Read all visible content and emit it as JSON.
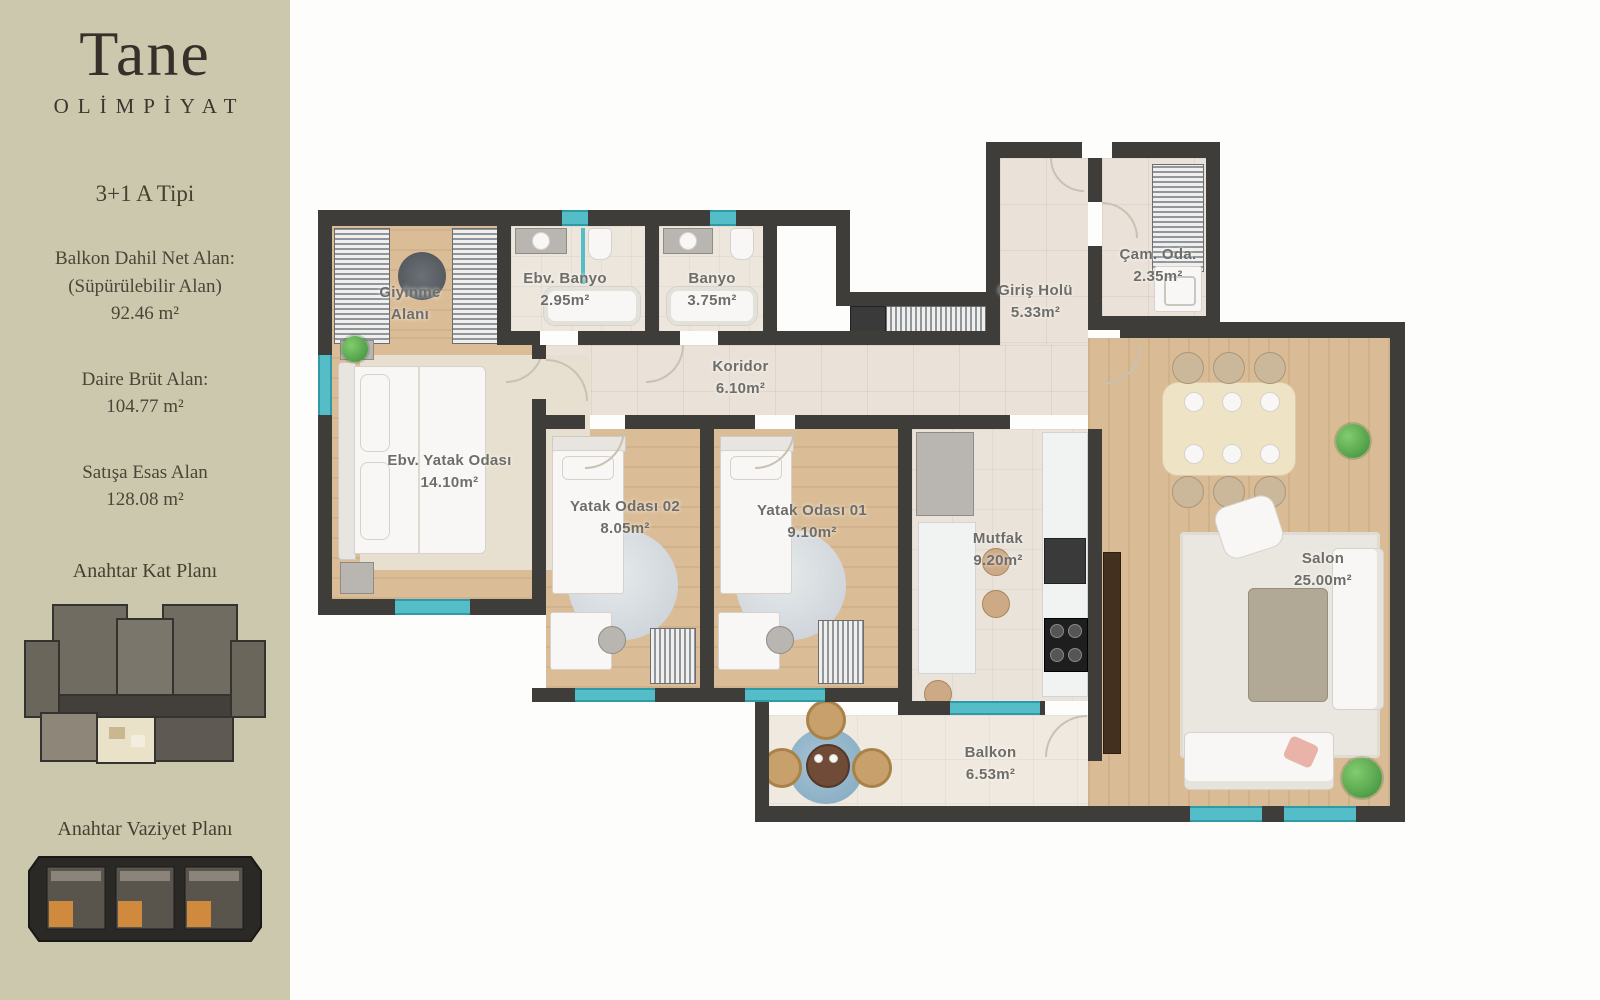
{
  "sidebar": {
    "brand": {
      "name": "Tane",
      "subtitle": "OLİMPİYAT"
    },
    "unit_type": "3+1 A Tipi",
    "stats": [
      {
        "label_line1": "Balkon Dahil Net Alan:",
        "label_line2": "(Süpürülebilir Alan)",
        "value": "92.46 m²"
      },
      {
        "label_line1": "Daire Brüt Alan:",
        "label_line2": "",
        "value": "104.77 m²"
      },
      {
        "label_line1": "Satışa Esas Alan",
        "label_line2": "",
        "value": "128.08 m²"
      }
    ],
    "plans": [
      {
        "title": "Anahtar Kat Planı"
      },
      {
        "title": "Anahtar Vaziyet Planı"
      }
    ]
  },
  "floor_plan": {
    "rooms": [
      {
        "name": "Giyinme Alanı",
        "label_lines": [
          "Giyinme",
          "Alanı"
        ]
      },
      {
        "name": "Ebv. Banyo",
        "area_m2": "2.95m²",
        "label_lines": [
          "Ebv. Banyo",
          "2.95m²"
        ]
      },
      {
        "name": "Banyo",
        "area_m2": "3.75m²",
        "label_lines": [
          "Banyo",
          "3.75m²"
        ]
      },
      {
        "name": "Çam. Oda.",
        "area_m2": "2.35m²",
        "label_lines": [
          "Çam. Oda.",
          "2.35m²"
        ]
      },
      {
        "name": "Giriş Holü",
        "area_m2": "5.33m²",
        "label_lines": [
          "Giriş Holü",
          "5.33m²"
        ]
      },
      {
        "name": "Koridor",
        "area_m2": "6.10m²",
        "label_lines": [
          "Koridor",
          "6.10m²"
        ]
      },
      {
        "name": "Ebv. Yatak Odası",
        "area_m2": "14.10m²",
        "label_lines": [
          "Ebv. Yatak Odası",
          "14.10m²"
        ]
      },
      {
        "name": "Yatak Odası 02",
        "area_m2": "8.05m²",
        "label_lines": [
          "Yatak Odası 02",
          "8.05m²"
        ]
      },
      {
        "name": "Yatak Odası 01",
        "area_m2": "9.10m²",
        "label_lines": [
          "Yatak Odası 01",
          "9.10m²"
        ]
      },
      {
        "name": "Mutfak",
        "area_m2": "9.20m²",
        "label_lines": [
          "Mutfak",
          "9.20m²"
        ]
      },
      {
        "name": "Salon",
        "area_m2": "25.00m²",
        "label_lines": [
          "Salon",
          "25.00m²"
        ]
      },
      {
        "name": "Balkon",
        "area_m2": "6.53m²",
        "label_lines": [
          "Balkon",
          "6.53m²"
        ]
      }
    ]
  },
  "colors": {
    "sidebar_background": "#ccc8ae",
    "wall": "#3f3d3a",
    "wood_floor": "#d9bc95",
    "tile_floor": "#eae2d8",
    "window_teal": "#55bdc8",
    "highlight_unit_cream": "#e9e1c8",
    "highlight_unit_orange": "#d08a3e",
    "label_text": "#6f6d69"
  }
}
